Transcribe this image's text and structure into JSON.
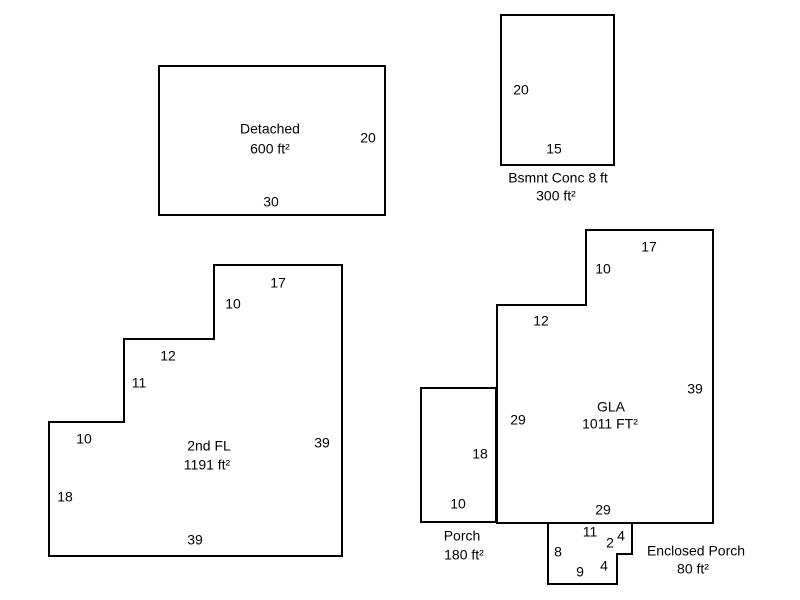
{
  "diagram": {
    "background_color": "#ffffff",
    "line_color": "#000000",
    "text_color": "#000000",
    "shapes": [
      {
        "name": "detached-garage",
        "area_label": "Detached",
        "area_value": "600 ft²",
        "points": [
          [
            159,
            66
          ],
          [
            385,
            66
          ],
          [
            385,
            215
          ],
          [
            159,
            215
          ]
        ],
        "labels": [
          {
            "text": "Detached",
            "x": 270,
            "y": 130
          },
          {
            "text": "600 ft²",
            "x": 270,
            "y": 150
          },
          {
            "text": "20",
            "x": 368,
            "y": 139
          },
          {
            "text": "30",
            "x": 271,
            "y": 203
          }
        ]
      },
      {
        "name": "basement-concrete",
        "area_label": "Bsmnt Conc 8 ft",
        "area_value": "300 ft²",
        "points": [
          [
            501,
            15
          ],
          [
            614,
            15
          ],
          [
            614,
            165
          ],
          [
            501,
            165
          ]
        ],
        "labels": [
          {
            "text": "20",
            "x": 521,
            "y": 91
          },
          {
            "text": "15",
            "x": 554,
            "y": 150
          },
          {
            "text": "Bsmnt Conc 8 ft",
            "x": 558,
            "y": 179
          },
          {
            "text": "300 ft²",
            "x": 556,
            "y": 197
          }
        ]
      },
      {
        "name": "second-floor",
        "area_label": "2nd FL",
        "area_value": "1191 ft²",
        "points": [
          [
            214,
            265
          ],
          [
            342,
            265
          ],
          [
            342,
            556
          ],
          [
            49,
            556
          ],
          [
            49,
            422
          ],
          [
            124,
            422
          ],
          [
            124,
            339
          ],
          [
            214,
            339
          ]
        ],
        "labels": [
          {
            "text": "17",
            "x": 278,
            "y": 284
          },
          {
            "text": "10",
            "x": 233,
            "y": 305
          },
          {
            "text": "12",
            "x": 168,
            "y": 357
          },
          {
            "text": "11",
            "x": 139,
            "y": 384
          },
          {
            "text": "10",
            "x": 84,
            "y": 440
          },
          {
            "text": "18",
            "x": 65,
            "y": 498
          },
          {
            "text": "2nd FL",
            "x": 209,
            "y": 447
          },
          {
            "text": "1191 ft²",
            "x": 207,
            "y": 466
          },
          {
            "text": "39",
            "x": 322,
            "y": 444
          },
          {
            "text": "39",
            "x": 195,
            "y": 541
          }
        ]
      },
      {
        "name": "gla-main-floor",
        "area_label": "GLA",
        "area_value": "1011 FT²",
        "points": [
          [
            586,
            230
          ],
          [
            713,
            230
          ],
          [
            713,
            523
          ],
          [
            497,
            523
          ],
          [
            497,
            305
          ],
          [
            586,
            305
          ]
        ],
        "labels": [
          {
            "text": "17",
            "x": 649,
            "y": 248
          },
          {
            "text": "10",
            "x": 603,
            "y": 270
          },
          {
            "text": "12",
            "x": 541,
            "y": 322
          },
          {
            "text": "29",
            "x": 518,
            "y": 421
          },
          {
            "text": "GLA",
            "x": 611,
            "y": 408
          },
          {
            "text": "1011 FT²",
            "x": 610,
            "y": 425
          },
          {
            "text": "39",
            "x": 695,
            "y": 390
          },
          {
            "text": "29",
            "x": 603,
            "y": 511
          }
        ]
      },
      {
        "name": "porch",
        "area_label": "Porch",
        "area_value": "180 ft²",
        "points": [
          [
            421,
            388
          ],
          [
            496,
            388
          ],
          [
            496,
            522
          ],
          [
            421,
            522
          ]
        ],
        "labels": [
          {
            "text": "18",
            "x": 480,
            "y": 455
          },
          {
            "text": "10",
            "x": 458,
            "y": 505
          },
          {
            "text": "Porch",
            "x": 462,
            "y": 537
          },
          {
            "text": "180 ft²",
            "x": 464,
            "y": 556
          }
        ]
      },
      {
        "name": "enclosed-porch",
        "area_label": "Enclosed Porch",
        "area_value": "80 ft²",
        "points": [
          [
            548,
            523
          ],
          [
            632,
            523
          ],
          [
            632,
            554
          ],
          [
            617,
            554
          ],
          [
            617,
            584
          ],
          [
            548,
            584
          ]
        ],
        "labels": [
          {
            "text": "11",
            "x": 590,
            "y": 533
          },
          {
            "text": "4",
            "x": 621,
            "y": 537
          },
          {
            "text": "2",
            "x": 610,
            "y": 544
          },
          {
            "text": "8",
            "x": 558,
            "y": 553
          },
          {
            "text": "9",
            "x": 580,
            "y": 573
          },
          {
            "text": "4",
            "x": 604,
            "y": 567
          },
          {
            "text": "Enclosed Porch",
            "x": 696,
            "y": 552
          },
          {
            "text": "80 ft²",
            "x": 693,
            "y": 570
          }
        ]
      }
    ]
  }
}
